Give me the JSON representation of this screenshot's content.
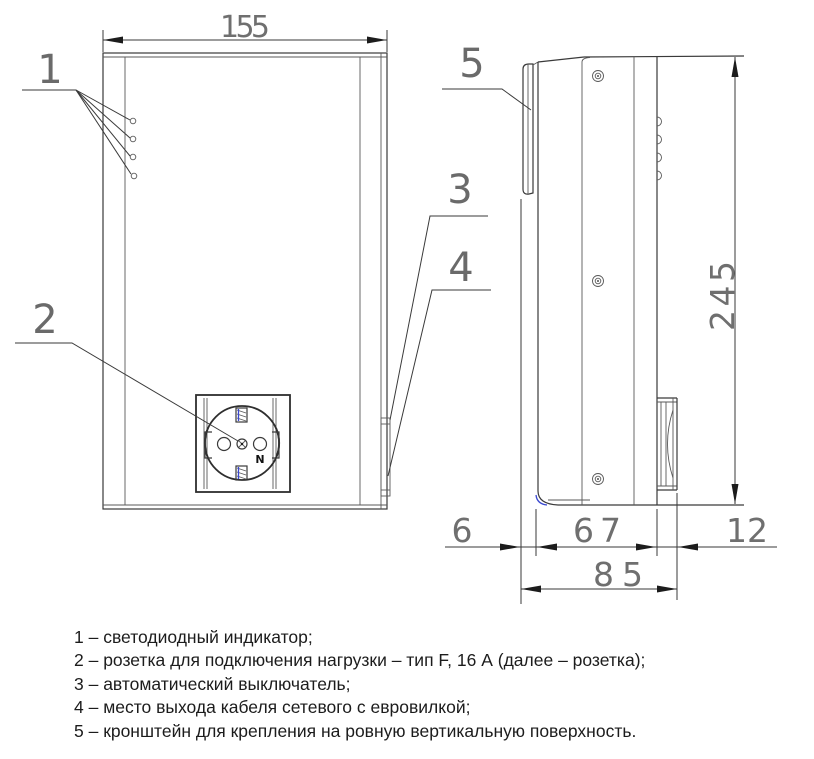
{
  "drawing": {
    "dimensions": {
      "width_mm": "155",
      "height_mm": "245",
      "bracket_depth_mm": "6",
      "body_depth_mm": "67",
      "socket_protrusion_mm": "12",
      "total_depth_mm": "85"
    },
    "callouts": {
      "c1": "1",
      "c2": "2",
      "c3": "3",
      "c4": "4",
      "c5": "5"
    },
    "socket": {
      "neutral_label": "N"
    }
  },
  "legend": {
    "items": [
      "1 – светодиодный индикатор;",
      "2 – розетка для подключения нагрузки – тип F, 16 А (далее – розетка);",
      "3 – автоматический выключатель;",
      "4 – место выхода кабеля сетевого с евровилкой;",
      "5 – кронштейн для крепления на ровную вертикальную поверхность."
    ]
  },
  "colors": {
    "line": "#3a3a3a",
    "dim_text": "#6f6f6f",
    "legend_text": "#1c1c1c",
    "accent_blue": "#3947d0"
  }
}
